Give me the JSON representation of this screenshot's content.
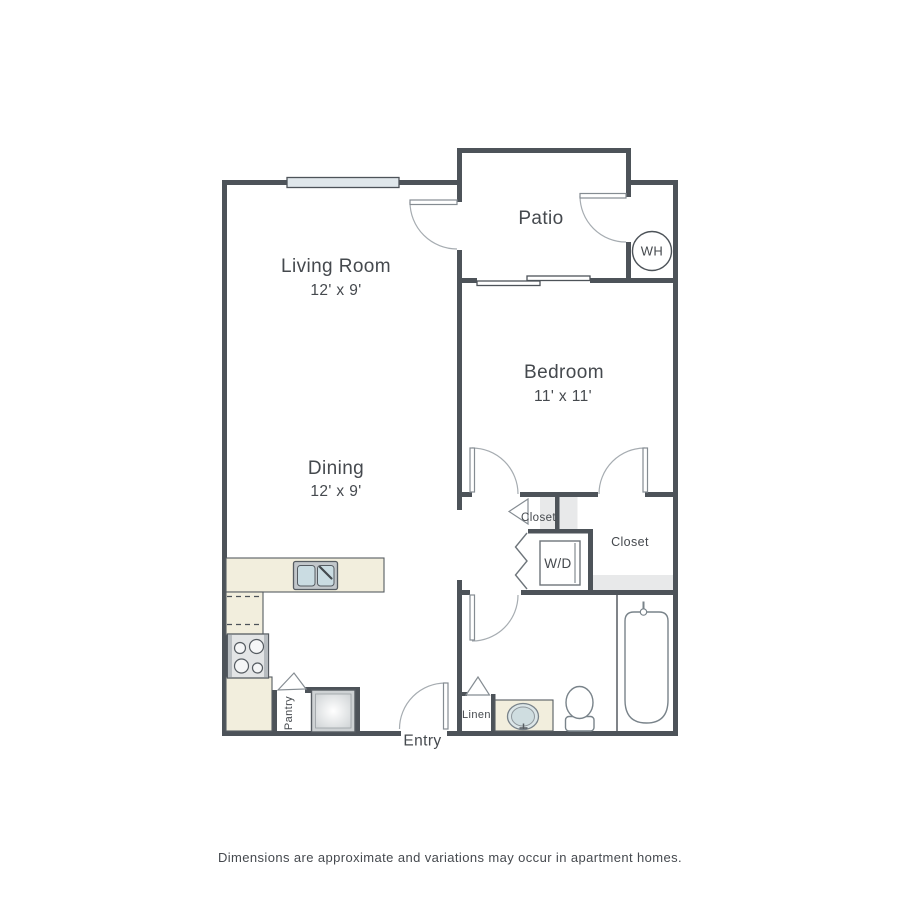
{
  "colors": {
    "wall": "#4d5359",
    "door_leaf_stroke": "#858c92",
    "door_arc": "#a6acb1",
    "counter": "#f2eedd",
    "window": "#e0e7eb",
    "tub": "#d5e0e2",
    "sink_basin": "#cadce2",
    "shelf": "#e8e9ea",
    "text": "#45494e"
  },
  "rooms": {
    "living_room": {
      "label": "Living Room",
      "dims": "12' x 9'"
    },
    "dining": {
      "label": "Dining",
      "dims": "12' x 9'"
    },
    "bedroom": {
      "label": "Bedroom",
      "dims": "11' x 11'"
    },
    "patio": {
      "label": "Patio"
    }
  },
  "features": {
    "water_heater": "WH",
    "washer_dryer": "W/D",
    "closet_hall": "Closet",
    "closet_bedroom": "Closet",
    "pantry": "Pantry",
    "linen": "Linen",
    "entry": "Entry"
  },
  "disclaimer": "Dimensions are approximate and variations may occur in apartment homes."
}
